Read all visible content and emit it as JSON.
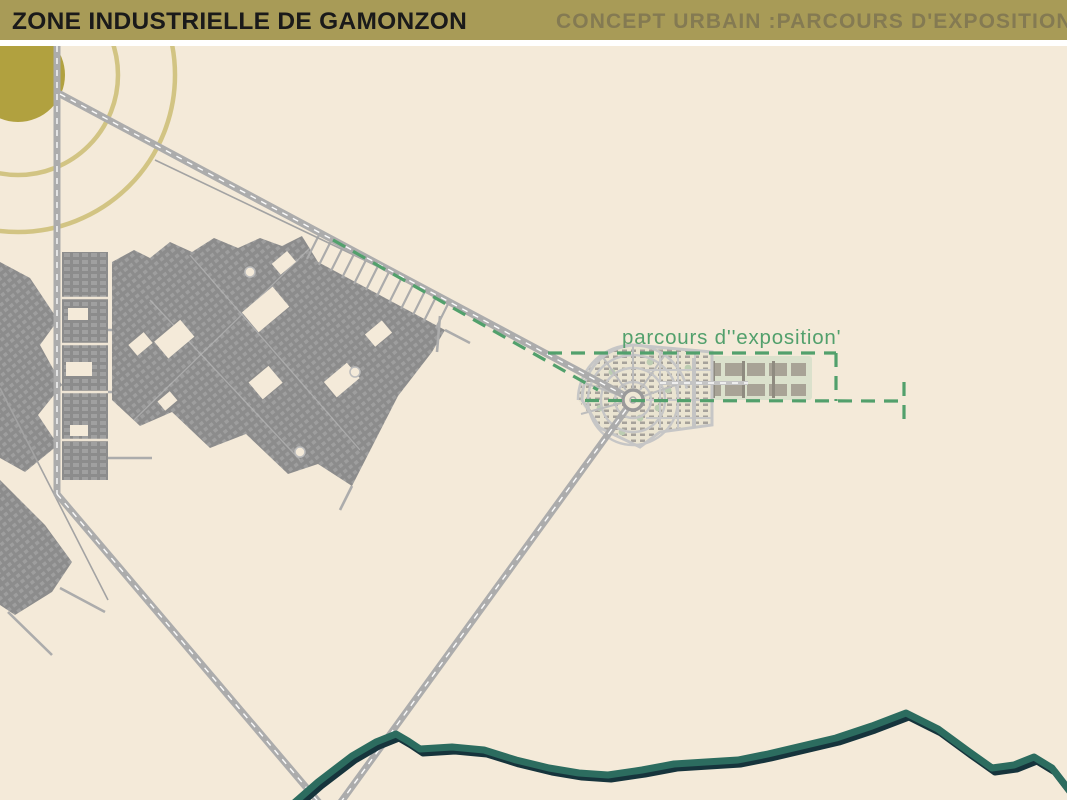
{
  "header": {
    "title_left": "ZONE INDUSTRIELLE DE GAMONZON",
    "title_right": "CONCEPT URBAIN :PARCOURS D'EXPOSITION"
  },
  "map": {
    "route_label": "parcours d''exposition'",
    "features": {
      "sun": "gold sun disc with concentric radial rings, top-left",
      "industrial_zone": "dense gray industrial urban fabric, left-center",
      "exposition_plaza": "radial fan-shaped plaza development at route junction",
      "exhibition_strip": "rectangular exhibition building strip east of plaza",
      "river": "dark teal river meandering along bottom",
      "route": "green dashed exposition path from industrial zone to plaza and strip"
    }
  },
  "theme": {
    "header-gold": "#A89B57",
    "header-left-text": "#1a1a1a",
    "header-right-text": "#847A52",
    "bg-cream": "#F4EAD9",
    "sun-gold": "#B1A13F",
    "ring-olive": "#C9BA6D",
    "road-gray": "#ACACAC",
    "road-dash": "#FFFFFF",
    "fabric-gray": "#8C8C8C",
    "route-green": "#52A06C",
    "river-teal": "#2C6C5F",
    "river-shadow": "#16343C",
    "plaza-road": "#C6C6C6",
    "band-bg": "#DBE1CC",
    "band-building": "#A8A396"
  }
}
